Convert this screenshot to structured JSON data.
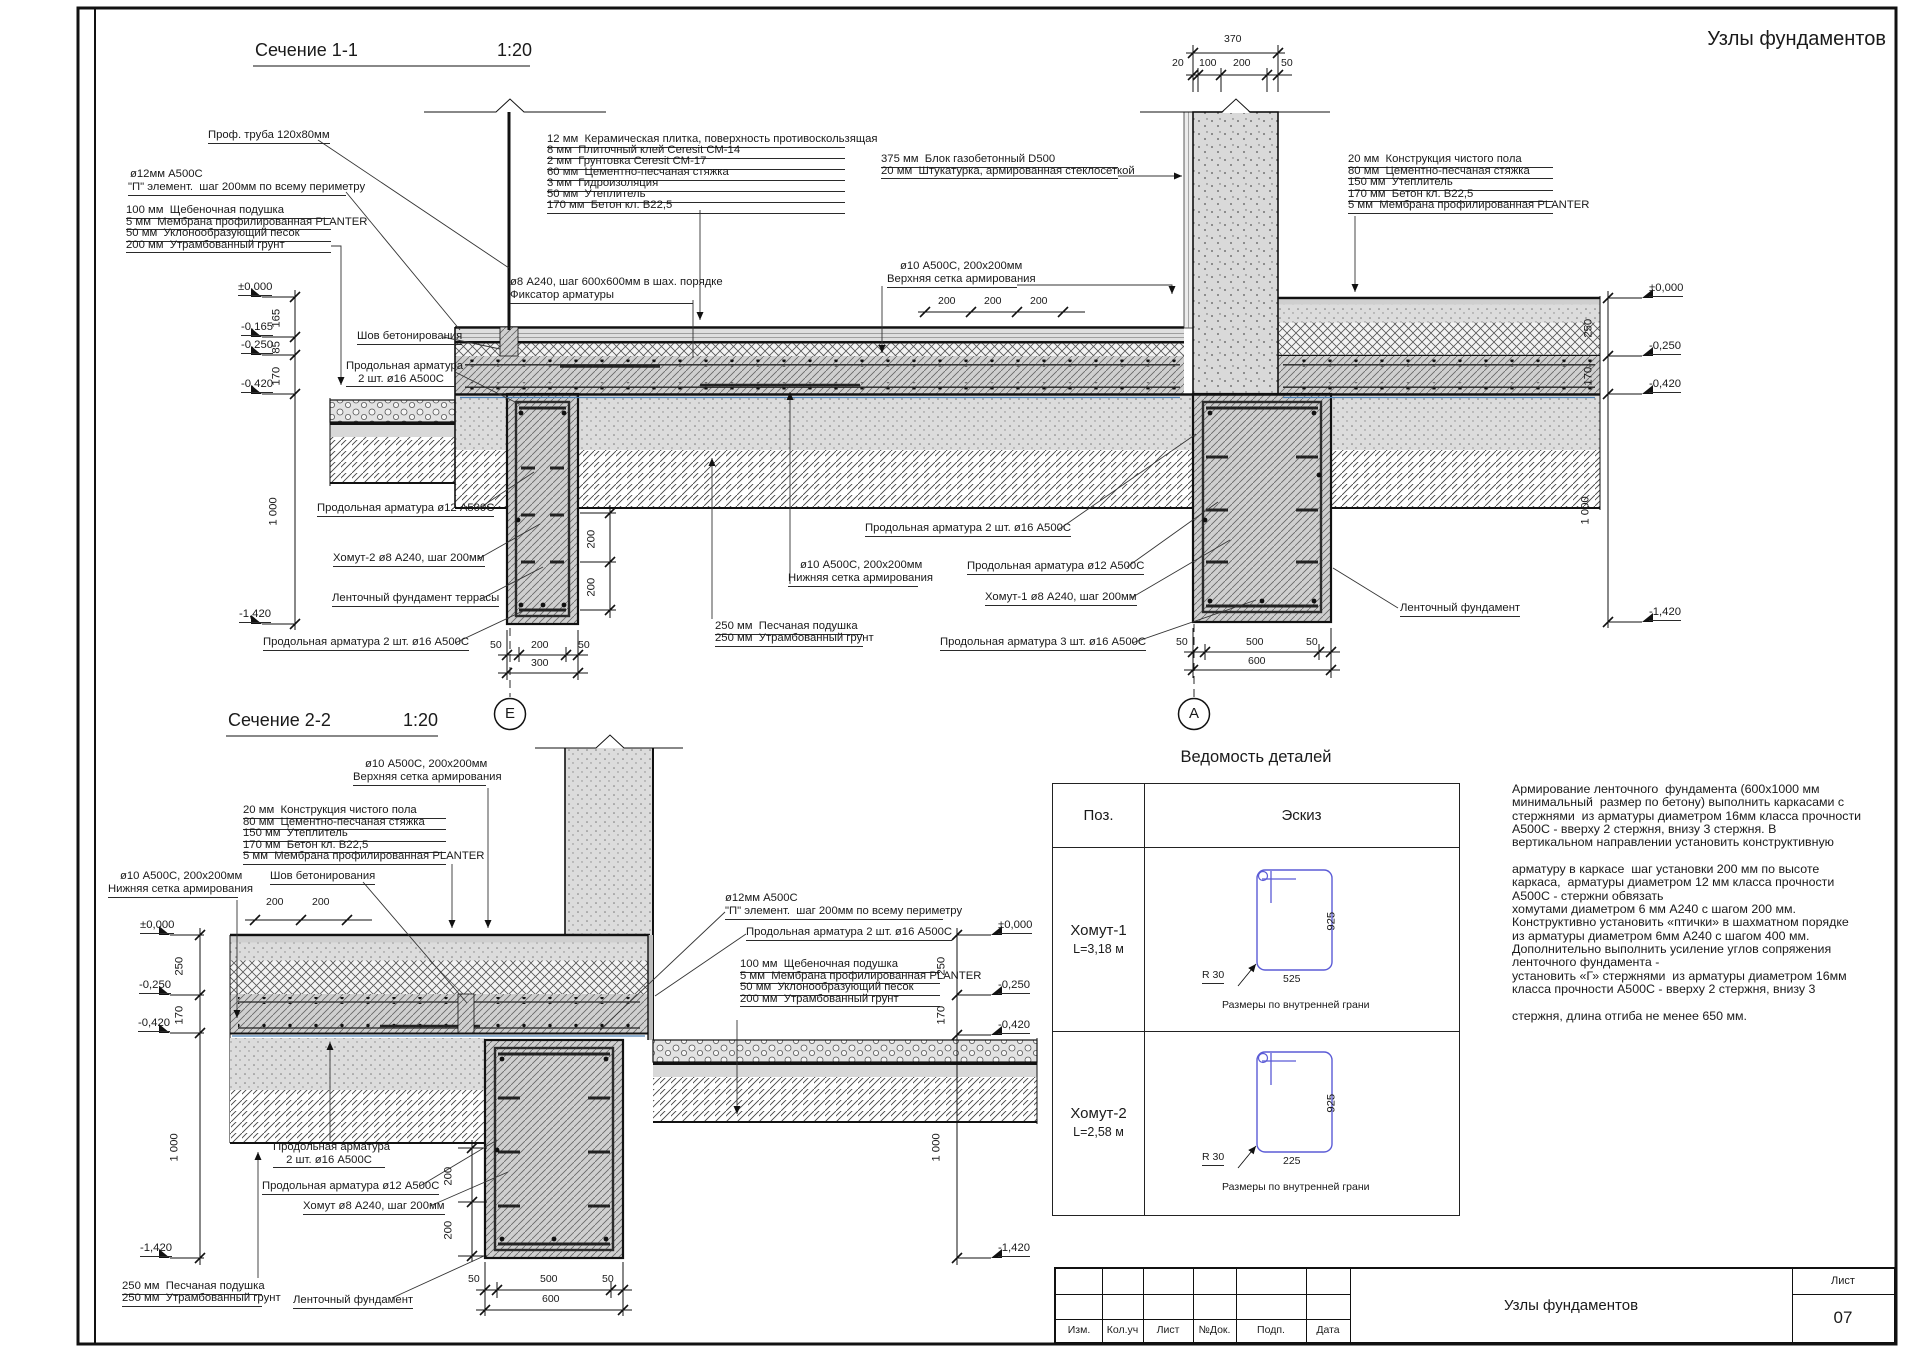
{
  "corner_title": "Узлы фундаментов",
  "accent_colors": {
    "line": "#1a1a1a",
    "sketch_blue": "#5b5bd6",
    "membrane_blue": "#4a7fb5"
  },
  "s1": {
    "labels": [
      {
        "t": "Сечение 1-1",
        "x": 255,
        "y": 40,
        "fs": 18,
        "n": "section-1-title"
      },
      {
        "t": "1:20",
        "x": 497,
        "y": 40,
        "fs": 18,
        "n": "section-1-scale"
      },
      {
        "t": "Проф. труба 120х80мм",
        "x": 208,
        "y": 129,
        "u": 1
      },
      {
        "t": "ø12мм А500С",
        "x": 130,
        "y": 168
      },
      {
        "t": "\"П\" элемент.  шаг 200мм по всему периметру",
        "x": 128,
        "y": 181,
        "u": 1,
        "w": 218
      },
      {
        "t": "100 мм  Щебеночная подушка",
        "x": 126,
        "y": 204,
        "u": 1,
        "w": 205
      },
      {
        "t": "5 мм  Мембрана профилированная PLANTER",
        "x": 126,
        "y": 215.5,
        "u": 1,
        "w": 205
      },
      {
        "t": "50 мм  Уклонообразующий песок",
        "x": 126,
        "y": 227,
        "u": 1,
        "w": 205
      },
      {
        "t": "200 мм  Утрамбованный грунт",
        "x": 126,
        "y": 238.5,
        "u": 1,
        "w": 205
      },
      {
        "t": "12 мм  Керамическая плитка, поверхность противоскользящая",
        "x": 547,
        "y": 133,
        "u": 1,
        "w": 298
      },
      {
        "t": "8 мм  Плиточный клей Ceresit СМ-14",
        "x": 547,
        "y": 144,
        "u": 1,
        "w": 298
      },
      {
        "t": "2 мм  Грунтовка Ceresit СМ-17",
        "x": 547,
        "y": 155,
        "u": 1,
        "w": 298
      },
      {
        "t": "60 мм  Цементно-песчаная стяжка",
        "x": 547,
        "y": 166,
        "u": 1,
        "w": 298
      },
      {
        "t": "3 мм  Гидроизоляция",
        "x": 547,
        "y": 177,
        "u": 1,
        "w": 298
      },
      {
        "t": "50 мм  Утеплитель",
        "x": 547,
        "y": 188,
        "u": 1,
        "w": 298
      },
      {
        "t": "170 мм  Бетон кл. В22,5",
        "x": 547,
        "y": 199,
        "u": 1,
        "w": 298
      },
      {
        "t": "375 мм  Блок газобетонный D500",
        "x": 881,
        "y": 153,
        "u": 1,
        "w": 237
      },
      {
        "t": "20 мм  Штукатурка, армированная стеклосеткой",
        "x": 881,
        "y": 164.5,
        "u": 1,
        "w": 237
      },
      {
        "t": "20 мм  Конструкция чистого пола",
        "x": 1348,
        "y": 153,
        "u": 1,
        "w": 205
      },
      {
        "t": "80 мм  Цементно-песчаная стяжка",
        "x": 1348,
        "y": 164.5,
        "u": 1,
        "w": 205
      },
      {
        "t": "150 мм  Утеплитель",
        "x": 1348,
        "y": 176,
        "u": 1,
        "w": 205
      },
      {
        "t": "170 мм  Бетон кл. В22,5",
        "x": 1348,
        "y": 187.5,
        "u": 1,
        "w": 205
      },
      {
        "t": "5 мм  Мембрана профилированная PLANTER",
        "x": 1348,
        "y": 199,
        "u": 1,
        "w": 205
      },
      {
        "t": "ø8 А240, шаг 600х600мм в шах. порядке",
        "x": 510,
        "y": 276
      },
      {
        "t": "Фиксатор арматуры",
        "x": 510,
        "y": 289,
        "u": 1,
        "w": 183
      },
      {
        "t": "ø10 А500С, 200х200мм",
        "x": 900,
        "y": 260
      },
      {
        "t": "Верхняя сетка армирования",
        "x": 887,
        "y": 273,
        "u": 1,
        "w": 130
      },
      {
        "t": "200",
        "x": 938,
        "y": 296,
        "fs": 10.5
      },
      {
        "t": "200",
        "x": 984,
        "y": 296,
        "fs": 10.5
      },
      {
        "t": "200",
        "x": 1030,
        "y": 296,
        "fs": 10.5
      },
      {
        "t": "370",
        "x": 1224,
        "y": 34,
        "fs": 10.5
      },
      {
        "t": "20",
        "x": 1172,
        "y": 58,
        "fs": 10.5
      },
      {
        "t": "100",
        "x": 1199,
        "y": 58,
        "fs": 10.5
      },
      {
        "t": "200",
        "x": 1233,
        "y": 58,
        "fs": 10.5
      },
      {
        "t": "50",
        "x": 1281,
        "y": 58,
        "fs": 10.5
      },
      {
        "t": "Шов бетонирования",
        "x": 357,
        "y": 330,
        "u": 1
      },
      {
        "t": "Продольная арматура\n2 шт. ø16 А500С",
        "x": 346,
        "y": 360,
        "w": 110,
        "a": "c",
        "u": 1
      },
      {
        "t": "Продольная арматура ø12 А500С",
        "x": 317,
        "y": 502,
        "u": 1
      },
      {
        "t": "Хомут-2 ø8 А240, шаг 200мм",
        "x": 333,
        "y": 552,
        "u": 1
      },
      {
        "t": "Ленточный фундамент террасы",
        "x": 332,
        "y": 592,
        "u": 1
      },
      {
        "t": "Продольная арматура 2 шт. ø16 А500С",
        "x": 263,
        "y": 636,
        "u": 1
      },
      {
        "t": "ø10 А500С, 200х200мм",
        "x": 800,
        "y": 559
      },
      {
        "t": "Нижняя сетка армирования",
        "x": 788,
        "y": 572,
        "u": 1,
        "w": 130
      },
      {
        "t": "250 мм  Песчаная подушка",
        "x": 715,
        "y": 620,
        "u": 1,
        "w": 148
      },
      {
        "t": "250 мм  Утрамбованный грунт",
        "x": 715,
        "y": 632,
        "u": 1,
        "w": 148
      },
      {
        "t": "Продольная арматура 2 шт. ø16 А500С",
        "x": 865,
        "y": 522,
        "u": 1
      },
      {
        "t": "Продольная арматура ø12 А500С",
        "x": 967,
        "y": 560,
        "u": 1
      },
      {
        "t": "Хомут-1 ø8 А240, шаг 200мм",
        "x": 985,
        "y": 591,
        "u": 1
      },
      {
        "t": "Продольная арматура 3 шт. ø16 А500С",
        "x": 940,
        "y": 636,
        "u": 1
      },
      {
        "t": "Ленточный фундамент",
        "x": 1400,
        "y": 602,
        "u": 1
      },
      {
        "t": "±0,000",
        "x": 238,
        "y": 281,
        "u": 1,
        "n": "level-mark"
      },
      {
        "t": "-0,165",
        "x": 241,
        "y": 321,
        "u": 1,
        "n": "level-mark"
      },
      {
        "t": "-0,250",
        "x": 241,
        "y": 339,
        "u": 1,
        "n": "level-mark"
      },
      {
        "t": "-0,420",
        "x": 241,
        "y": 378,
        "u": 1,
        "n": "level-mark"
      },
      {
        "t": "-1,420",
        "x": 239,
        "y": 608,
        "u": 1,
        "n": "level-mark"
      },
      {
        "t": "165",
        "x": 283,
        "y": 315,
        "r": 1
      },
      {
        "t": "85",
        "x": 283,
        "y": 341,
        "r": 1
      },
      {
        "t": "170",
        "x": 283,
        "y": 373,
        "r": 1
      },
      {
        "t": "1 000",
        "x": 280,
        "y": 513,
        "r": 1
      },
      {
        "t": "±0,000",
        "x": 1649,
        "y": 282,
        "u": 1,
        "n": "level-mark"
      },
      {
        "t": "-0,250",
        "x": 1649,
        "y": 340,
        "u": 1,
        "n": "level-mark"
      },
      {
        "t": "-0,420",
        "x": 1649,
        "y": 378,
        "u": 1,
        "n": "level-mark"
      },
      {
        "t": "-1,420",
        "x": 1649,
        "y": 606,
        "u": 1,
        "n": "level-mark"
      },
      {
        "t": "250",
        "x": 1595,
        "y": 325,
        "r": 1
      },
      {
        "t": "170",
        "x": 1595,
        "y": 373,
        "r": 1
      },
      {
        "t": "1 000",
        "x": 1592,
        "y": 512,
        "r": 1
      },
      {
        "t": "50",
        "x": 490,
        "y": 640,
        "fs": 10.5
      },
      {
        "t": "200",
        "x": 531,
        "y": 640,
        "fs": 10.5
      },
      {
        "t": "50",
        "x": 578,
        "y": 640,
        "fs": 10.5
      },
      {
        "t": "300",
        "x": 531,
        "y": 658,
        "fs": 10.5
      },
      {
        "t": "50",
        "x": 1176,
        "y": 637,
        "fs": 10.5
      },
      {
        "t": "500",
        "x": 1246,
        "y": 637,
        "fs": 10.5
      },
      {
        "t": "50",
        "x": 1306,
        "y": 637,
        "fs": 10.5
      },
      {
        "t": "600",
        "x": 1248,
        "y": 656,
        "fs": 10.5
      },
      {
        "t": "200",
        "x": 598,
        "y": 536,
        "r": 1
      },
      {
        "t": "200",
        "x": 598,
        "y": 584,
        "r": 1
      },
      {
        "t": "Е",
        "x": 503,
        "y": 706,
        "fs": 15,
        "w": 14,
        "a": "c",
        "n": "axis-label-e"
      },
      {
        "t": "А",
        "x": 1187,
        "y": 706,
        "fs": 15,
        "w": 14,
        "a": "c",
        "n": "axis-label-a"
      }
    ]
  },
  "s2": {
    "labels": [
      {
        "t": "Сечение 2-2",
        "x": 228,
        "y": 710,
        "fs": 18,
        "n": "section-2-title"
      },
      {
        "t": "1:20",
        "x": 403,
        "y": 710,
        "fs": 18,
        "n": "section-2-scale"
      },
      {
        "t": "ø10 А500С, 200х200мм",
        "x": 365,
        "y": 758
      },
      {
        "t": "Верхняя сетка армирования",
        "x": 353,
        "y": 771,
        "u": 1,
        "w": 133
      },
      {
        "t": "20 мм  Конструкция чистого пола",
        "x": 243,
        "y": 804,
        "u": 1,
        "w": 203
      },
      {
        "t": "80 мм  Цементно-песчаная стяжка",
        "x": 243,
        "y": 815.5,
        "u": 1,
        "w": 203
      },
      {
        "t": "150 мм  Утеплитель",
        "x": 243,
        "y": 827,
        "u": 1,
        "w": 203
      },
      {
        "t": "170 мм  Бетон кл. В22,5",
        "x": 243,
        "y": 838.5,
        "u": 1,
        "w": 203
      },
      {
        "t": "5 мм  Мембрана профилированная PLANTER",
        "x": 243,
        "y": 850,
        "u": 1,
        "w": 203
      },
      {
        "t": "ø10 А500С, 200х200мм",
        "x": 120,
        "y": 870
      },
      {
        "t": "Нижняя сетка армирования",
        "x": 108,
        "y": 883,
        "u": 1,
        "w": 130
      },
      {
        "t": "Шов бетонирования",
        "x": 270,
        "y": 870,
        "u": 1
      },
      {
        "t": "200",
        "x": 266,
        "y": 897,
        "fs": 10.5
      },
      {
        "t": "200",
        "x": 312,
        "y": 897,
        "fs": 10.5
      },
      {
        "t": "ø12мм А500С",
        "x": 725,
        "y": 892
      },
      {
        "t": "\"П\" элемент.  шаг 200мм по всему периметру",
        "x": 725,
        "y": 905,
        "u": 1,
        "w": 218
      },
      {
        "t": "Продольная арматура 2 шт. ø16 А500С",
        "x": 746,
        "y": 926,
        "u": 1
      },
      {
        "t": "100 мм  Щебеночная подушка",
        "x": 740,
        "y": 958,
        "u": 1,
        "w": 200
      },
      {
        "t": "5 мм  Мембрана профилированная PLANTER",
        "x": 740,
        "y": 969.5,
        "u": 1,
        "w": 200
      },
      {
        "t": "50 мм  Уклонообразующий песок",
        "x": 740,
        "y": 981,
        "u": 1,
        "w": 200
      },
      {
        "t": "200 мм  Утрамбованный грунт",
        "x": 740,
        "y": 992.5,
        "u": 1,
        "w": 200
      },
      {
        "t": "±0,000",
        "x": 140,
        "y": 919,
        "u": 1,
        "n": "level-mark"
      },
      {
        "t": "-0,250",
        "x": 139,
        "y": 979,
        "u": 1,
        "n": "level-mark"
      },
      {
        "t": "-0,420",
        "x": 138,
        "y": 1017,
        "u": 1,
        "n": "level-mark"
      },
      {
        "t": "-1,420",
        "x": 140,
        "y": 1242,
        "u": 1,
        "n": "level-mark"
      },
      {
        "t": "250",
        "x": 186,
        "y": 963,
        "r": 1
      },
      {
        "t": "170",
        "x": 186,
        "y": 1012,
        "r": 1
      },
      {
        "t": "1 000",
        "x": 181,
        "y": 1149,
        "r": 1
      },
      {
        "t": "±0,000",
        "x": 998,
        "y": 919,
        "u": 1,
        "n": "level-mark"
      },
      {
        "t": "-0,250",
        "x": 998,
        "y": 979,
        "u": 1,
        "n": "level-mark"
      },
      {
        "t": "-0,420",
        "x": 998,
        "y": 1019,
        "u": 1,
        "n": "level-mark"
      },
      {
        "t": "-1,420",
        "x": 998,
        "y": 1242,
        "u": 1,
        "n": "level-mark"
      },
      {
        "t": "250",
        "x": 948,
        "y": 963,
        "r": 1
      },
      {
        "t": "170",
        "x": 948,
        "y": 1012,
        "r": 1
      },
      {
        "t": "1 000",
        "x": 943,
        "y": 1149,
        "r": 1
      },
      {
        "t": "Продольная арматура\n2 шт. ø16 А500С",
        "x": 273,
        "y": 1141,
        "w": 112,
        "a": "c",
        "u": 1
      },
      {
        "t": "Продольная арматура ø12 А500С",
        "x": 262,
        "y": 1180,
        "u": 1
      },
      {
        "t": "Хомут ø8 А240, шаг 200мм",
        "x": 303,
        "y": 1200,
        "u": 1
      },
      {
        "t": "250 мм  Песчаная подушка",
        "x": 122,
        "y": 1280,
        "u": 1,
        "w": 140
      },
      {
        "t": "250 мм  Утрамбованный грунт",
        "x": 122,
        "y": 1292,
        "u": 1,
        "w": 140
      },
      {
        "t": "Ленточный фундамент",
        "x": 293,
        "y": 1294,
        "u": 1
      },
      {
        "t": "50",
        "x": 468,
        "y": 1274,
        "fs": 10.5
      },
      {
        "t": "500",
        "x": 540,
        "y": 1274,
        "fs": 10.5
      },
      {
        "t": "50",
        "x": 602,
        "y": 1274,
        "fs": 10.5
      },
      {
        "t": "600",
        "x": 542,
        "y": 1294,
        "fs": 10.5
      },
      {
        "t": "200",
        "x": 455,
        "y": 1173,
        "r": 1
      },
      {
        "t": "200",
        "x": 455,
        "y": 1227,
        "r": 1
      }
    ]
  },
  "details": {
    "title": "Ведомость деталей",
    "col_pos": "Поз.",
    "col_sketch": "Эскиз",
    "rows": [
      {
        "name": "Хомут-1",
        "length": "L=3,18 м"
      },
      {
        "name": "Хомут-2",
        "length": "L=2,58 м"
      }
    ],
    "labels": [
      {
        "t": "925",
        "x": 1338,
        "y": 918,
        "r": 1
      },
      {
        "t": "525",
        "x": 1283,
        "y": 974,
        "fs": 10.5
      },
      {
        "t": "R 30",
        "x": 1202,
        "y": 970,
        "u": 1,
        "fs": 10.5
      },
      {
        "t": "Размеры по внутренней грани",
        "x": 1222,
        "y": 1000,
        "fs": 10.5
      },
      {
        "t": "925",
        "x": 1338,
        "y": 1100,
        "r": 1
      },
      {
        "t": "225",
        "x": 1283,
        "y": 1156,
        "fs": 10.5
      },
      {
        "t": "R 30",
        "x": 1202,
        "y": 1152,
        "u": 1,
        "fs": 10.5
      },
      {
        "t": "Размеры по внутренней грани",
        "x": 1222,
        "y": 1182,
        "fs": 10.5
      }
    ]
  },
  "notes": {
    "text": "Армирование ленточного  фундамента (600х1000 мм\nминимальный  размер по бетону) выполнить каркасами с\nстержнями  из арматуры диаметром 16мм класса прочности\nА500С - вверху 2 стержня, внизу 3 стержня. В\nвертикальном направлении установить конструктивную\n\nарматуру в каркасе  шаг установки 200 мм по высоте\nкаркаса,  арматуры диаметром 12 мм класса прочности\nА500С - стержни обвязать\nхомутами диаметром 6 мм А240 с шагом 200 мм.\nКонструктивно установить «птички» в шахматном порядке\nиз арматуры диаметром 6мм А240 с шагом 400 мм.\nДополнительно выполнить усиление углов сопряжения\nленточного фундамента -\nустановить «Г» стержнями  из арматуры диаметром 16мм\nкласса прочности А500С - вверху 2 стержня, внизу 3\n\nстержня, длина отгиба не менее 650 мм."
  },
  "titleblock": {
    "cols": [
      "Изм.",
      "Кол.уч",
      "Лист",
      "№Док.",
      "Подп.",
      "Дата"
    ],
    "title": "Узлы фундаментов",
    "sheet_label": "Лист",
    "sheet_number": "07"
  }
}
